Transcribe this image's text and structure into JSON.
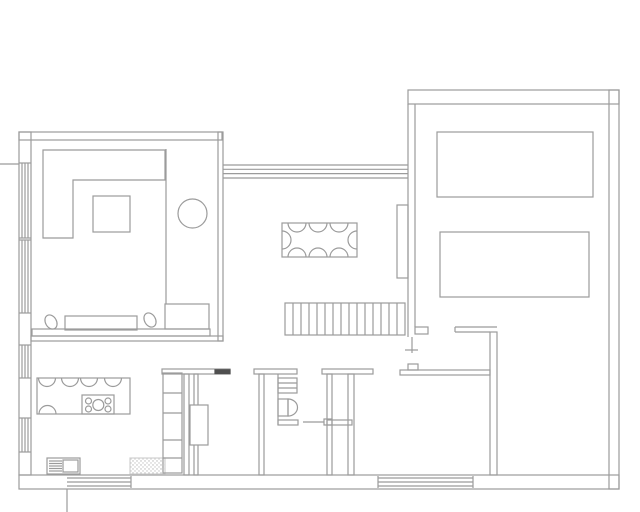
{
  "title": "house-floor-plan",
  "canvas": {
    "width": 640,
    "height": 512
  },
  "colors": {
    "line": "#9b9b9b",
    "line_light": "#c9c9c9",
    "threshold": "#4f4f4f",
    "background": "#ffffff"
  },
  "plan": {
    "groups": [
      {
        "name": "exterior-walls",
        "prims": [
          {
            "t": "rect",
            "x": 19,
            "y": 132,
            "w": 203,
            "h": 8
          },
          {
            "t": "rect",
            "x": 19,
            "y": 132,
            "w": 12,
            "h": 343
          },
          {
            "t": "rect",
            "x": 19,
            "y": 475,
            "w": 600,
            "h": 14
          },
          {
            "t": "rect",
            "x": 609,
            "y": 90,
            "w": 10,
            "h": 399
          },
          {
            "t": "rect",
            "x": 408,
            "y": 90,
            "w": 211,
            "h": 14
          },
          {
            "t": "line",
            "x1": 0,
            "y1": 164,
            "x2": 19,
            "y2": 164
          },
          {
            "t": "line",
            "x1": 67,
            "y1": 489,
            "x2": 67,
            "y2": 512
          }
        ]
      },
      {
        "name": "clerestory-window-band",
        "prims": [
          {
            "t": "line",
            "x1": 223,
            "y1": 165,
            "x2": 408,
            "y2": 165
          },
          {
            "t": "line",
            "x1": 223,
            "y1": 169.3,
            "x2": 408,
            "y2": 169.3
          },
          {
            "t": "line",
            "x1": 223,
            "y1": 173.6,
            "x2": 408,
            "y2": 173.6
          },
          {
            "t": "line",
            "x1": 223,
            "y1": 178,
            "x2": 408,
            "y2": 178
          }
        ]
      },
      {
        "name": "left-wall-windows",
        "prims": [
          {
            "t": "line",
            "x1": 19,
            "y1": 163,
            "x2": 31,
            "y2": 163
          },
          {
            "t": "line",
            "x1": 19,
            "y1": 238,
            "x2": 31,
            "y2": 238
          },
          {
            "t": "line",
            "x1": 19,
            "y1": 240,
            "x2": 31,
            "y2": 240
          },
          {
            "t": "line",
            "x1": 19,
            "y1": 313,
            "x2": 31,
            "y2": 313
          },
          {
            "t": "line",
            "x1": 19,
            "y1": 345,
            "x2": 31,
            "y2": 345
          },
          {
            "t": "line",
            "x1": 19,
            "y1": 378,
            "x2": 31,
            "y2": 378
          },
          {
            "t": "line",
            "x1": 19,
            "y1": 418,
            "x2": 31,
            "y2": 418
          },
          {
            "t": "line",
            "x1": 19,
            "y1": 452,
            "x2": 31,
            "y2": 452
          },
          {
            "t": "line",
            "x1": 22,
            "y1": 163,
            "x2": 22,
            "y2": 238
          },
          {
            "t": "line",
            "x1": 25,
            "y1": 163,
            "x2": 25,
            "y2": 238
          },
          {
            "t": "line",
            "x1": 28,
            "y1": 163,
            "x2": 28,
            "y2": 238
          },
          {
            "t": "line",
            "x1": 22,
            "y1": 240,
            "x2": 22,
            "y2": 313
          },
          {
            "t": "line",
            "x1": 25,
            "y1": 240,
            "x2": 25,
            "y2": 313
          },
          {
            "t": "line",
            "x1": 28,
            "y1": 240,
            "x2": 28,
            "y2": 313
          },
          {
            "t": "line",
            "x1": 22,
            "y1": 345,
            "x2": 22,
            "y2": 378
          },
          {
            "t": "line",
            "x1": 25,
            "y1": 345,
            "x2": 25,
            "y2": 378
          },
          {
            "t": "line",
            "x1": 28,
            "y1": 345,
            "x2": 28,
            "y2": 378
          },
          {
            "t": "line",
            "x1": 22,
            "y1": 418,
            "x2": 22,
            "y2": 452
          },
          {
            "t": "line",
            "x1": 25,
            "y1": 418,
            "x2": 25,
            "y2": 452
          },
          {
            "t": "line",
            "x1": 28,
            "y1": 418,
            "x2": 28,
            "y2": 452
          }
        ]
      },
      {
        "name": "living-dining-wall",
        "prims": [
          {
            "t": "rect",
            "x": 218,
            "y": 132,
            "w": 5,
            "h": 209
          }
        ]
      },
      {
        "name": "living-kitchen-wall",
        "prims": [
          {
            "t": "rect",
            "x": 31,
            "y": 336,
            "w": 192,
            "h": 5
          }
        ]
      },
      {
        "name": "garage-left-wall",
        "prims": [
          {
            "t": "line",
            "x1": 408,
            "y1": 104,
            "x2": 408,
            "y2": 337
          },
          {
            "t": "line",
            "x1": 415,
            "y1": 104,
            "x2": 415,
            "y2": 327
          },
          {
            "t": "rect",
            "x": 415,
            "y": 327,
            "w": 13,
            "h": 7
          },
          {
            "t": "line",
            "x1": 412,
            "y1": 337,
            "x2": 412,
            "y2": 353
          },
          {
            "t": "line",
            "x1": 405,
            "y1": 350,
            "x2": 418,
            "y2": 350
          }
        ]
      },
      {
        "name": "garage-furniture",
        "prims": [
          {
            "t": "rect",
            "x": 437,
            "y": 132,
            "w": 156,
            "h": 65
          },
          {
            "t": "rect",
            "x": 440,
            "y": 232,
            "w": 149,
            "h": 65
          }
        ]
      },
      {
        "name": "mudroom-walls",
        "prims": [
          {
            "t": "line",
            "x1": 455,
            "y1": 327,
            "x2": 497,
            "y2": 327
          },
          {
            "t": "line",
            "x1": 455,
            "y1": 332,
            "x2": 490,
            "y2": 332
          },
          {
            "t": "line",
            "x1": 455,
            "y1": 327,
            "x2": 455,
            "y2": 332
          },
          {
            "t": "rect",
            "x": 490,
            "y": 332,
            "w": 7,
            "h": 143
          },
          {
            "t": "rect",
            "x": 400,
            "y": 370,
            "w": 90,
            "h": 5
          },
          {
            "t": "rect",
            "x": 408,
            "y": 364,
            "w": 10,
            "h": 6
          }
        ]
      },
      {
        "name": "utility-partition-walls",
        "prims": [
          {
            "t": "rect",
            "x": 162,
            "y": 369,
            "w": 68,
            "h": 5
          },
          {
            "t": "rect",
            "x": 215,
            "y": 369.8,
            "w": 15,
            "h": 3.8,
            "fill": "#4f4f4f",
            "stroke": "#4f4f4f"
          },
          {
            "t": "rect",
            "x": 184,
            "y": 374,
            "w": 5,
            "h": 101
          },
          {
            "t": "rect",
            "x": 194,
            "y": 374,
            "w": 4,
            "h": 101
          },
          {
            "t": "rect",
            "x": 254,
            "y": 369,
            "w": 43,
            "h": 5
          },
          {
            "t": "rect",
            "x": 259,
            "y": 374,
            "w": 5,
            "h": 101
          },
          {
            "t": "rect",
            "x": 322,
            "y": 369,
            "w": 51,
            "h": 5
          },
          {
            "t": "rect",
            "x": 327,
            "y": 374,
            "w": 5,
            "h": 101
          },
          {
            "t": "rect",
            "x": 348,
            "y": 374,
            "w": 6,
            "h": 101
          },
          {
            "t": "rect",
            "x": 327,
            "y": 420,
            "w": 25,
            "h": 5
          },
          {
            "t": "line",
            "x1": 278,
            "y1": 374,
            "x2": 278,
            "y2": 425
          }
        ]
      },
      {
        "name": "wc-fixtures",
        "prims": [
          {
            "t": "rect",
            "x": 278,
            "y": 378,
            "w": 19,
            "h": 15
          },
          {
            "t": "line",
            "x1": 278,
            "y1": 383,
            "x2": 297,
            "y2": 383
          },
          {
            "t": "line",
            "x1": 278,
            "y1": 388,
            "x2": 297,
            "y2": 388
          },
          {
            "t": "rect",
            "x": 278,
            "y": 399,
            "w": 10,
            "h": 17
          },
          {
            "t": "path",
            "d": "M288,399 A9.5,8.5 0 0 1 288,416 Z"
          },
          {
            "t": "rect",
            "x": 278,
            "y": 420,
            "w": 20,
            "h": 5
          },
          {
            "t": "line",
            "x1": 303,
            "y1": 422,
            "x2": 324,
            "y2": 422
          },
          {
            "t": "rect",
            "x": 324,
            "y": 419,
            "w": 8,
            "h": 6
          }
        ]
      },
      {
        "name": "staircase",
        "prims": [
          {
            "t": "rect",
            "x": 285,
            "y": 303,
            "w": 120,
            "h": 32
          },
          {
            "t": "line",
            "x1": 293,
            "y1": 303,
            "x2": 293,
            "y2": 335
          },
          {
            "t": "line",
            "x1": 301,
            "y1": 303,
            "x2": 301,
            "y2": 335
          },
          {
            "t": "line",
            "x1": 309,
            "y1": 303,
            "x2": 309,
            "y2": 335
          },
          {
            "t": "line",
            "x1": 317,
            "y1": 303,
            "x2": 317,
            "y2": 335
          },
          {
            "t": "line",
            "x1": 325,
            "y1": 303,
            "x2": 325,
            "y2": 335
          },
          {
            "t": "line",
            "x1": 333,
            "y1": 303,
            "x2": 333,
            "y2": 335
          },
          {
            "t": "line",
            "x1": 341,
            "y1": 303,
            "x2": 341,
            "y2": 335
          },
          {
            "t": "line",
            "x1": 349,
            "y1": 303,
            "x2": 349,
            "y2": 335
          },
          {
            "t": "line",
            "x1": 357,
            "y1": 303,
            "x2": 357,
            "y2": 335
          },
          {
            "t": "line",
            "x1": 365,
            "y1": 303,
            "x2": 365,
            "y2": 335
          },
          {
            "t": "line",
            "x1": 373,
            "y1": 303,
            "x2": 373,
            "y2": 335
          },
          {
            "t": "line",
            "x1": 381,
            "y1": 303,
            "x2": 381,
            "y2": 335
          },
          {
            "t": "line",
            "x1": 389,
            "y1": 303,
            "x2": 389,
            "y2": 335
          },
          {
            "t": "line",
            "x1": 397,
            "y1": 303,
            "x2": 397,
            "y2": 335
          }
        ]
      },
      {
        "name": "dining-sideboard",
        "prims": [
          {
            "t": "rect",
            "x": 397,
            "y": 205,
            "w": 11,
            "h": 73
          }
        ]
      },
      {
        "name": "dining-set",
        "prims": [
          {
            "t": "rect",
            "x": 282,
            "y": 223,
            "w": 75,
            "h": 34
          },
          {
            "t": "path",
            "d": "M288,223 A9,9 0 0 0 306,223"
          },
          {
            "t": "path",
            "d": "M309,223 A9,9 0 0 0 327,223"
          },
          {
            "t": "path",
            "d": "M330,223 A9,9 0 0 0 348,223"
          },
          {
            "t": "path",
            "d": "M288,257 A9,9 0 0 1 306,257"
          },
          {
            "t": "path",
            "d": "M309,257 A9,9 0 0 1 327,257"
          },
          {
            "t": "path",
            "d": "M330,257 A9,9 0 0 1 348,257"
          },
          {
            "t": "path",
            "d": "M282,231 A9,9 0 0 1 282,249"
          },
          {
            "t": "path",
            "d": "M357,231 A9,9 0 0 0 357,249"
          }
        ]
      },
      {
        "name": "living-room-furniture",
        "prims": [
          {
            "t": "path",
            "d": "M43,150 L165,150 L165,180 L73,180 L73,238 L43,238 Z"
          },
          {
            "t": "rect",
            "x": 93,
            "y": 196,
            "w": 37,
            "h": 36
          },
          {
            "t": "circle",
            "cx": 192.5,
            "cy": 213.5,
            "r": 14.5
          },
          {
            "t": "line",
            "x1": 166,
            "y1": 149,
            "x2": 166,
            "y2": 304
          },
          {
            "t": "rect",
            "x": 165,
            "y": 304,
            "w": 44,
            "h": 25
          },
          {
            "t": "rect",
            "x": 32,
            "y": 329,
            "w": 178,
            "h": 7
          },
          {
            "t": "rect",
            "x": 65,
            "y": 316,
            "w": 72,
            "h": 14
          },
          {
            "t": "ellipse",
            "cx": 51,
            "cy": 322,
            "rx": 5.5,
            "ry": 7.5,
            "tf": "rotate(-30 51 322)"
          },
          {
            "t": "ellipse",
            "cx": 150,
            "cy": 320,
            "rx": 5.5,
            "ry": 7.5,
            "tf": "rotate(-30 150 320)"
          }
        ]
      },
      {
        "name": "kitchen-island",
        "prims": [
          {
            "t": "rect",
            "x": 37,
            "y": 378,
            "w": 93,
            "h": 36
          },
          {
            "t": "path",
            "d": "M38.5,378 A8.5,8.5 0 0 0 55.5,378"
          },
          {
            "t": "path",
            "d": "M61.5,378 A8.5,8.5 0 0 0 78.5,378"
          },
          {
            "t": "path",
            "d": "M80.5,378 A8.5,8.5 0 0 0 97.5,378"
          },
          {
            "t": "path",
            "d": "M104.5,378 A8.5,8.5 0 0 0 121.5,378"
          },
          {
            "t": "path",
            "d": "M39,414 A8.5,8.5 0 0 1 56,414"
          },
          {
            "t": "rect",
            "x": 82,
            "y": 395,
            "w": 32,
            "h": 19
          },
          {
            "t": "circle",
            "cx": 88.5,
            "cy": 401,
            "r": 3
          },
          {
            "t": "circle",
            "cx": 88.5,
            "cy": 409,
            "r": 3
          },
          {
            "t": "circle",
            "cx": 108,
            "cy": 401,
            "r": 3
          },
          {
            "t": "circle",
            "cx": 108,
            "cy": 409,
            "r": 3
          },
          {
            "t": "circle",
            "cx": 98.3,
            "cy": 405,
            "r": 5.5
          }
        ]
      },
      {
        "name": "kitchen-counter",
        "prims": [
          {
            "t": "rect",
            "x": 47,
            "y": 458,
            "w": 33,
            "h": 16
          },
          {
            "t": "line",
            "x1": 49,
            "y1": 461,
            "x2": 62,
            "y2": 461
          },
          {
            "t": "line",
            "x1": 49,
            "y1": 463.5,
            "x2": 62,
            "y2": 463.5
          },
          {
            "t": "line",
            "x1": 49,
            "y1": 466,
            "x2": 62,
            "y2": 466
          },
          {
            "t": "line",
            "x1": 49,
            "y1": 468.5,
            "x2": 62,
            "y2": 468.5
          },
          {
            "t": "line",
            "x1": 49,
            "y1": 471,
            "x2": 62,
            "y2": 471
          },
          {
            "t": "rect",
            "x": 63,
            "y": 460,
            "w": 15,
            "h": 12
          },
          {
            "t": "rect",
            "x": 130,
            "y": 458,
            "w": 35,
            "h": 16,
            "fill": "url(#dots)",
            "stroke": "#d0d0d0"
          },
          {
            "t": "rect",
            "x": 163,
            "y": 373,
            "w": 19,
            "h": 100
          },
          {
            "t": "line",
            "x1": 163,
            "y1": 393,
            "x2": 182,
            "y2": 393
          },
          {
            "t": "line",
            "x1": 163,
            "y1": 413,
            "x2": 182,
            "y2": 413
          },
          {
            "t": "line",
            "x1": 163,
            "y1": 440,
            "x2": 182,
            "y2": 440
          },
          {
            "t": "line",
            "x1": 163,
            "y1": 458,
            "x2": 182,
            "y2": 458
          },
          {
            "t": "rect",
            "x": 190,
            "y": 405,
            "w": 18,
            "h": 40,
            "fill": "#ffffff"
          }
        ]
      },
      {
        "name": "entry-steps",
        "prims": [
          {
            "t": "line",
            "x1": 67,
            "y1": 478,
            "x2": 131,
            "y2": 478
          },
          {
            "t": "line",
            "x1": 67,
            "y1": 482,
            "x2": 131,
            "y2": 482
          },
          {
            "t": "line",
            "x1": 67,
            "y1": 486,
            "x2": 131,
            "y2": 486
          },
          {
            "t": "line",
            "x1": 131,
            "y1": 476,
            "x2": 131,
            "y2": 488
          },
          {
            "t": "line",
            "x1": 378,
            "y1": 478,
            "x2": 473,
            "y2": 478
          },
          {
            "t": "line",
            "x1": 378,
            "y1": 482,
            "x2": 473,
            "y2": 482
          },
          {
            "t": "line",
            "x1": 378,
            "y1": 486,
            "x2": 473,
            "y2": 486
          },
          {
            "t": "line",
            "x1": 378,
            "y1": 476,
            "x2": 378,
            "y2": 488
          },
          {
            "t": "line",
            "x1": 473,
            "y1": 476,
            "x2": 473,
            "y2": 488
          }
        ]
      }
    ]
  }
}
